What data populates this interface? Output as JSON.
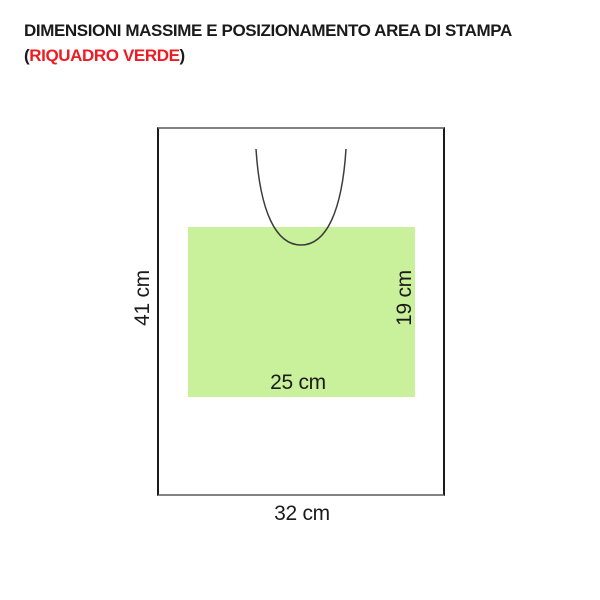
{
  "title": {
    "line1": "DIMENSIONI MASSIME E POSIZIONAMENTO AREA DI STAMPA",
    "line2_prefix": "(",
    "line2_highlight": "RIQUADRO VERDE",
    "line2_suffix": ")"
  },
  "diagram": {
    "bag_height_label": "41 cm",
    "bag_width_label": "32 cm",
    "print_height_label": "19 cm",
    "print_width_label": "25 cm"
  },
  "colors": {
    "title_text": "#1a1a1a",
    "highlight_red": "#ed1c24",
    "print_area_green": "#c9f19b",
    "outline_vertical": "#1b1b1b",
    "outline_horizontal": "#828282",
    "curve_stroke": "#3c3c3c",
    "label_text": "#1b1b1b"
  }
}
